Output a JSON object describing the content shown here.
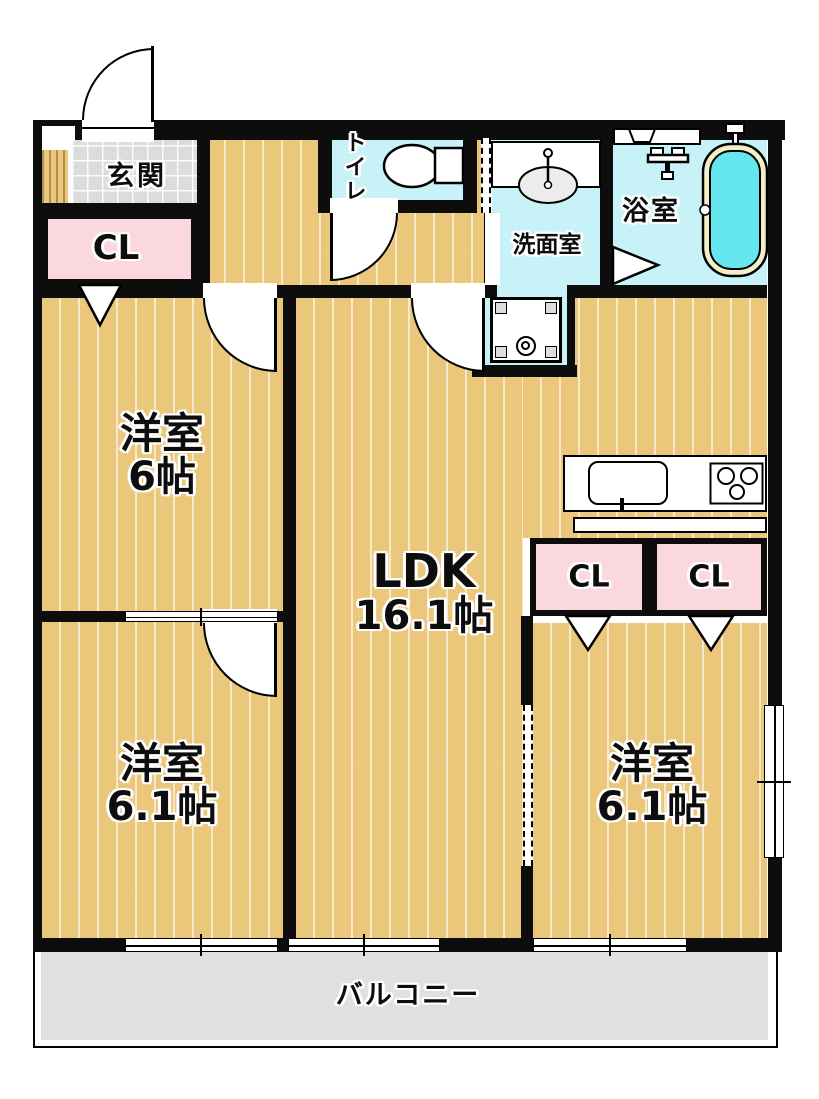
{
  "rooms": {
    "genkan": {
      "label": "玄関"
    },
    "closet_entrance": {
      "label": "CL"
    },
    "toilet": {
      "label": "トイレ"
    },
    "washroom": {
      "label": "洗面室"
    },
    "bathroom": {
      "label": "浴室"
    },
    "bedroom_top_left": {
      "label": "洋室",
      "size": "6帖"
    },
    "ldk": {
      "label": "LDK",
      "size": "16.1帖"
    },
    "closet_ldk_left": {
      "label": "CL"
    },
    "closet_ldk_right": {
      "label": "CL"
    },
    "bedroom_bottom_left": {
      "label": "洋室",
      "size": "6.1帖"
    },
    "bedroom_right": {
      "label": "洋室",
      "size": "6.1帖"
    },
    "balcony": {
      "label": "バルコニー"
    }
  },
  "colors": {
    "wall": "#0d0d0d",
    "floor_wood": "#EBC77C",
    "floor_tile": "#DCDCDC",
    "wet_area": "#C7F3F8",
    "closet_pink": "#FAD8DD",
    "bath_water": "#66E7EF",
    "tub_rim": "#F2EFC8",
    "balcony_gray": "#E0E0E0"
  }
}
